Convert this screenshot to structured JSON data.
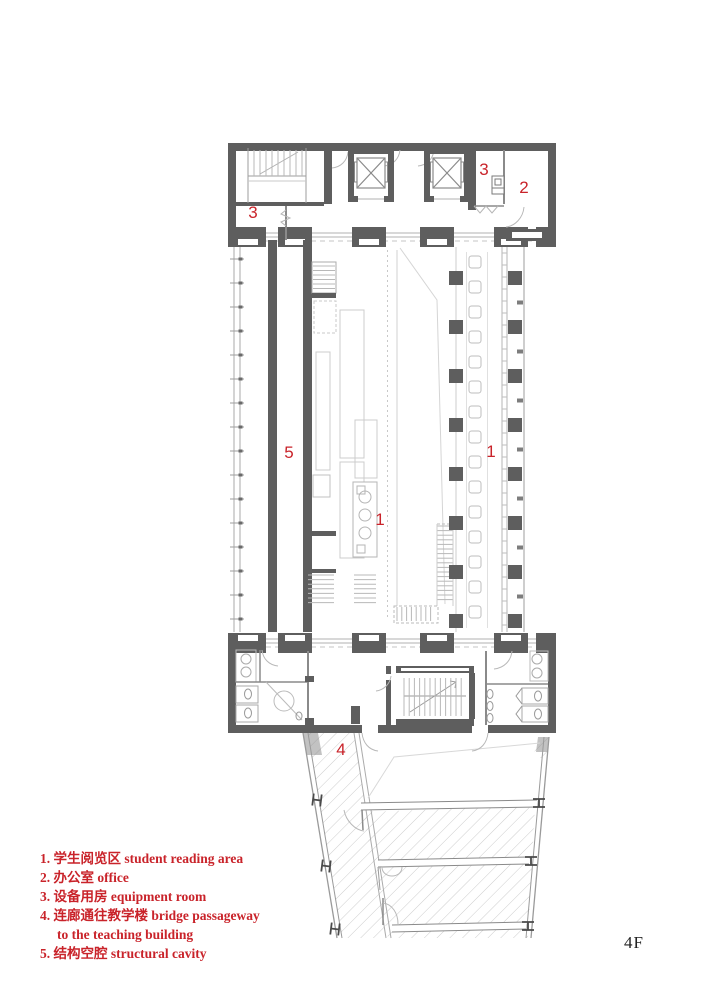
{
  "floor_label": "4F",
  "plan_marks": {
    "m1_center": "1",
    "m1_right": "1",
    "m2": "2",
    "m3_left": "3",
    "m3_right": "3",
    "m4": "4",
    "m5": "5"
  },
  "legend_lines": [
    "1. 学生阅览区  student reading area",
    "2. 办公室  office",
    "3. 设备用房  equipment room",
    "4. 连廊通往教学楼  bridge passageway",
    "to the teaching building",
    "5. 结构空腔  structural cavity"
  ],
  "colors": {
    "wall_gray": "#5e5e5e",
    "label_red": "#c9232a",
    "line_light": "#c4c4c4"
  }
}
